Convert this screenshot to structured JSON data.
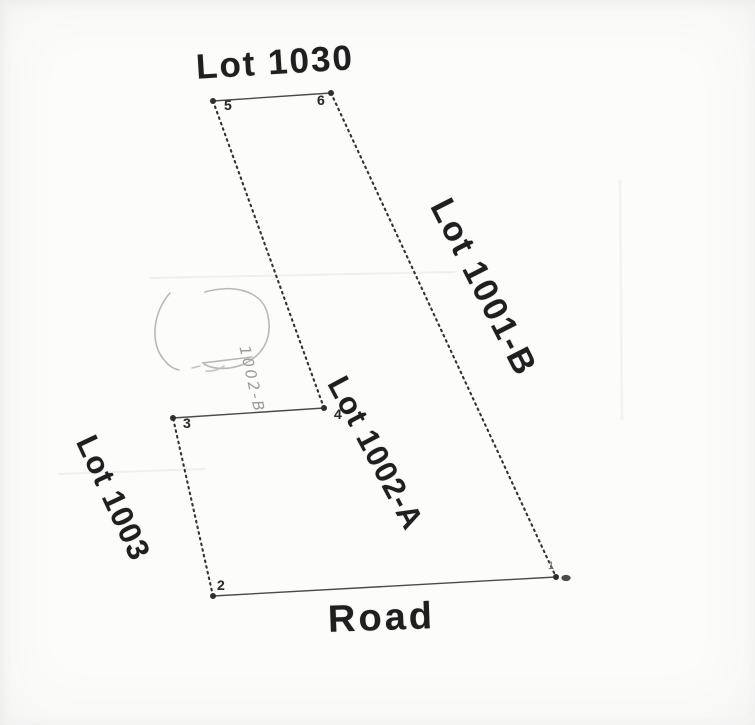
{
  "diagram": {
    "lot_labels": [
      {
        "id": "lot-1030",
        "text": "Lot 1030"
      },
      {
        "id": "lot-1001-b",
        "text": "Lot 1001-B"
      },
      {
        "id": "lot-1002-a",
        "text": "Lot 1002-A"
      },
      {
        "id": "lot-1003",
        "text": "Lot 1003"
      },
      {
        "id": "road",
        "text": "Road"
      }
    ],
    "vertices": [
      {
        "n": "1",
        "x": 556,
        "y": 577
      },
      {
        "n": "2",
        "x": 213,
        "y": 596
      },
      {
        "n": "3",
        "x": 173,
        "y": 418
      },
      {
        "n": "4",
        "x": 324,
        "y": 408
      },
      {
        "n": "5",
        "x": 213,
        "y": 101
      },
      {
        "n": "6",
        "x": 331,
        "y": 93
      }
    ],
    "edges": [
      {
        "from": "5",
        "to": "6",
        "style": "solid"
      },
      {
        "from": "6",
        "to": "1",
        "style": "dotted"
      },
      {
        "from": "1",
        "to": "2",
        "style": "solid"
      },
      {
        "from": "2",
        "to": "3",
        "style": "dotted"
      },
      {
        "from": "3",
        "to": "4",
        "style": "solid"
      },
      {
        "from": "4",
        "to": "5",
        "style": "dotted"
      }
    ],
    "monument_marker": {
      "at_vertex": "1",
      "dx": 10,
      "dy": 1
    },
    "pencil": {
      "note_text": "1002-B"
    },
    "colors": {
      "ink": "#2e2e2e",
      "solid_line": "#4a4a4a",
      "dotted_line": "#333333",
      "pencil": "#b8b8b8",
      "crease": "#efefef"
    }
  }
}
